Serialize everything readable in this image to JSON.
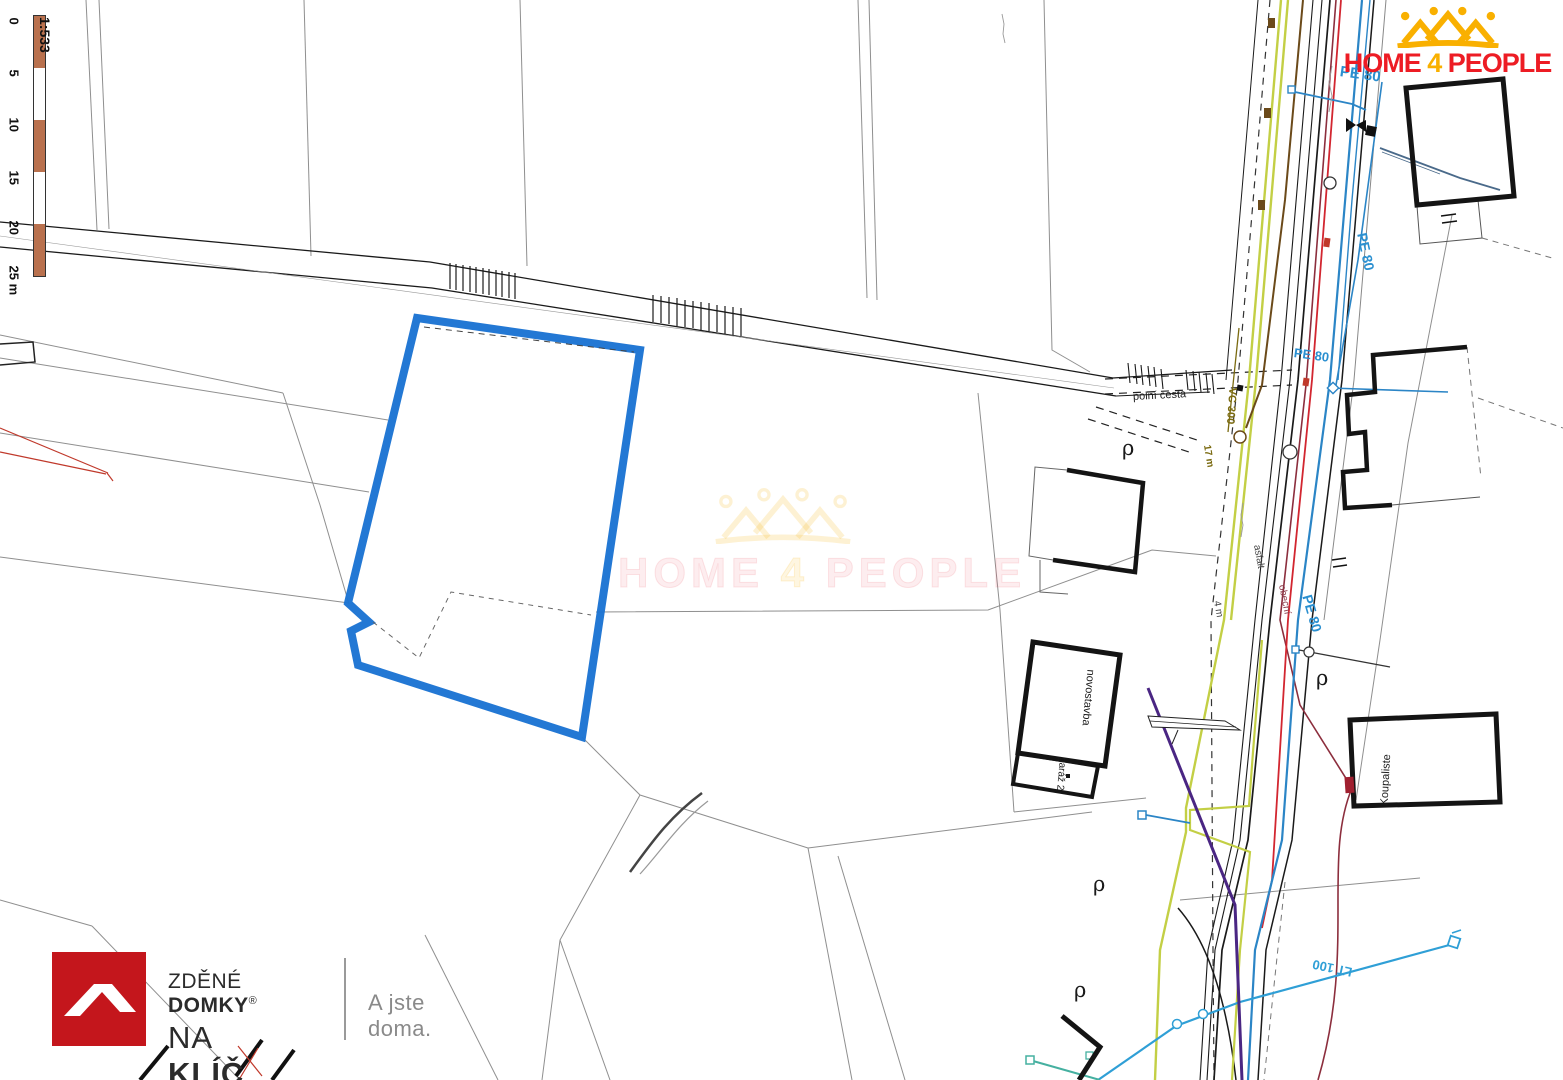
{
  "scalebar": {
    "ratio": "1:533",
    "ticks": [
      "0",
      "5",
      "10",
      "15",
      "20",
      "25 m"
    ],
    "bar_color": "#b9714e"
  },
  "logo": {
    "home": "HOME",
    "four": "4",
    "people": "PEOPLE"
  },
  "watermark": {
    "home": "HOME",
    "four": "4",
    "people": "PEOPLE"
  },
  "footer": {
    "brand_top_light": "ZDĚNÉ",
    "brand_top_bold": "DOMKY",
    "registered": "®",
    "brand_bottom_light": "NA",
    "brand_bottom_bold": "KLÍČ",
    "tagline": "A jste doma."
  },
  "map_labels": [
    {
      "text": "PE 80"
    },
    {
      "text": "PE 80"
    },
    {
      "text": "PE 80"
    },
    {
      "text": "PE 80"
    },
    {
      "text": "LT 100"
    },
    {
      "text": "VC 300"
    },
    {
      "text": "polní cesta"
    },
    {
      "text": "asfalt"
    },
    {
      "text": "obecní"
    },
    {
      "text": "17 m"
    },
    {
      "text": "4 m"
    },
    {
      "text": "Koupaliste"
    },
    {
      "text": "novostavba"
    },
    {
      "text": "garáž 2"
    },
    {
      "text": "ρ"
    },
    {
      "text": "ρ"
    },
    {
      "text": "ρ"
    },
    {
      "text": "ρ"
    }
  ],
  "colors": {
    "plot_outline": "#1a73d2",
    "water_pipe": "#2b85c6",
    "water_pipe_light": "#2f9fd6",
    "gas_line": "#c3cf45",
    "power_line": "#4a2683",
    "red_line": "#d22630",
    "maroon_line": "#8c2e3d",
    "brown_line": "#6b4a1a",
    "brand_red": "#ed1c24",
    "brand_yellow": "#f9b000",
    "footer_red": "#c4161c",
    "scale_bar_fill": "#b9714e"
  }
}
